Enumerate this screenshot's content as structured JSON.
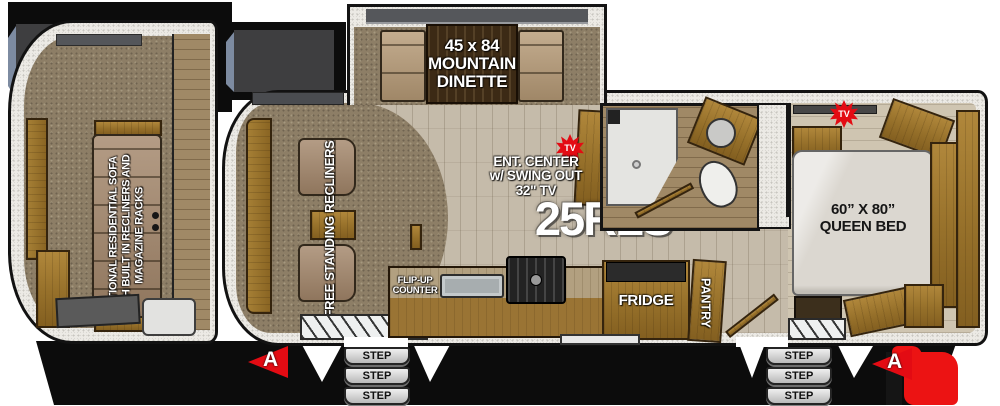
{
  "model": "25RLS",
  "colors": {
    "marker_red": "#e30b13",
    "cabinet_wood": "#96702a",
    "carpet": "#8d7e66",
    "vinyl_floor": "#c5bbaa",
    "wall": "#eceae5",
    "step_gray": "#d4d4d4",
    "label_white": "#ffffff"
  },
  "inset": {
    "label_lines": [
      "OPTIONAL RESIDENTIAL SOFA",
      "WITH BUILT IN RECLINERS AND",
      "MAGAZINE RACKS"
    ]
  },
  "dinette": {
    "lines": [
      "45 x 84",
      "MOUNTAIN",
      "DINETTE"
    ]
  },
  "ent_center": {
    "lines": [
      "ENT. CENTER",
      "w/ SWING OUT",
      "32\" TV"
    ]
  },
  "living": {
    "recliners_label": "FREE STANDING RECLINERS"
  },
  "kitchen": {
    "flip_up_lines": [
      "FLIP-UP",
      "COUNTER"
    ],
    "fridge_label": "FRIDGE",
    "pantry_label": "PANTRY"
  },
  "bedroom": {
    "bed_lines": [
      "60” X 80”",
      "QUEEN BED"
    ]
  },
  "badges": {
    "tv": "TV",
    "marker": "A"
  },
  "steps": {
    "label": "STEP"
  }
}
